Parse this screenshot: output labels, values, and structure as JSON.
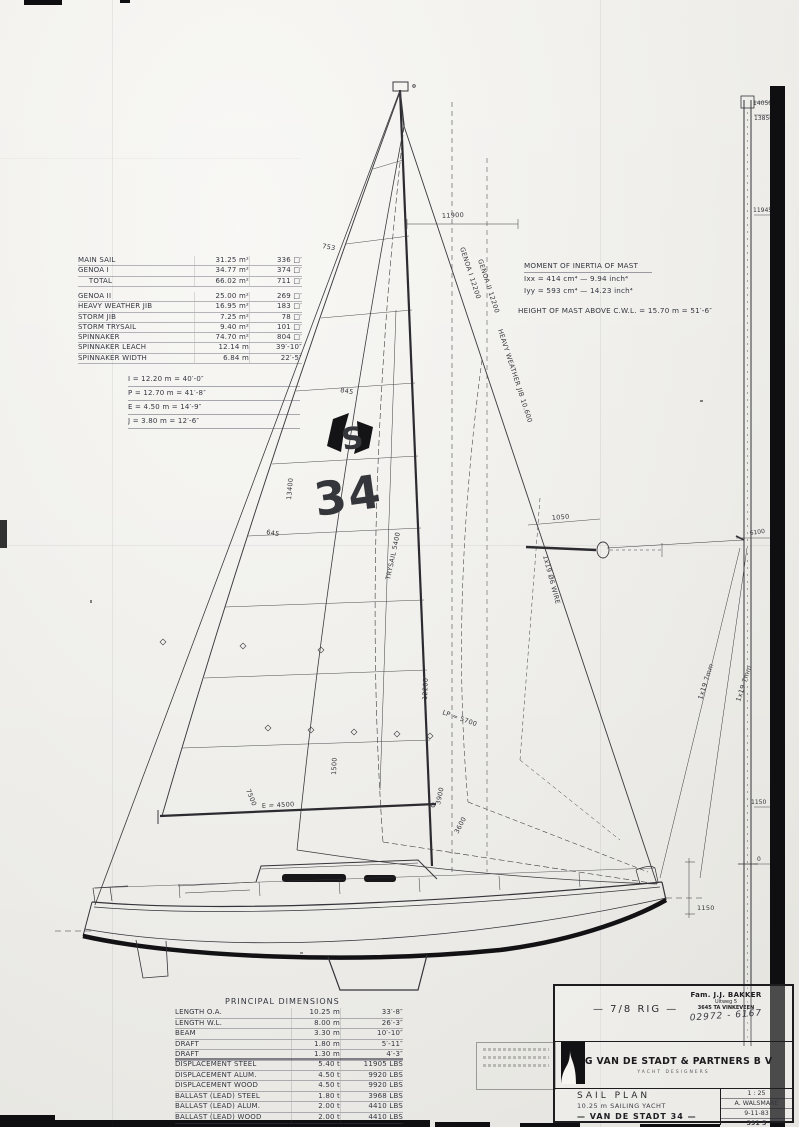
{
  "sheet": {
    "paper": "#f6f5f0",
    "ink": "#3a3a3e",
    "accent": "#111111"
  },
  "sail_table": {
    "group1": [
      {
        "label": "MAIN SAIL",
        "metric": "31.25 m²",
        "imperial": "336 □′"
      },
      {
        "label": "GENOA I",
        "metric": "34.77 m²",
        "imperial": "374 □′"
      },
      {
        "label": "  TOTAL",
        "metric": "66.02 m²",
        "imperial": "711 □′"
      }
    ],
    "group2": [
      {
        "label": "GENOA II",
        "metric": "25.00 m²",
        "imperial": "269 □′"
      },
      {
        "label": "HEAVY WEATHER JIB",
        "metric": "16.95 m²",
        "imperial": "183 □′"
      },
      {
        "label": "STORM JIB",
        "metric": "7.25 m²",
        "imperial": "78 □′"
      },
      {
        "label": "STORM TRYSAIL",
        "metric": "9.40 m²",
        "imperial": "101 □′"
      },
      {
        "label": "SPINNAKER",
        "metric": "74.70 m²",
        "imperial": "804 □′"
      },
      {
        "label": "SPINNAKER LEACH",
        "metric": "12.14 m",
        "imperial": "39′-10″"
      },
      {
        "label": "SPINNAKER WIDTH",
        "metric": "6.84 m",
        "imperial": "22′-5″"
      }
    ]
  },
  "rig_dims": [
    {
      "text": "I  =  12.20 m  =  40′-0″"
    },
    {
      "text": "P  =  12.70 m  =  41′-8″"
    },
    {
      "text": "E  =  4.50 m  =  14′-9″"
    },
    {
      "text": "J  =  3.80 m  =  12′-6″"
    }
  ],
  "inertia": {
    "title": "MOMENT OF INERTIA OF MAST",
    "rows": [
      {
        "text": "Ixx  =  414 cm⁴  —  9.94 inch⁴"
      },
      {
        "text": "Iyy  =  593 cm⁴  —  14.23 inch⁴"
      }
    ],
    "height_note": "HEIGHT OF MAST ABOVE C.W.L. = 15.70 m = 51′-6″"
  },
  "principal": {
    "title": "PRINCIPAL DIMENSIONS",
    "dims": [
      {
        "label": "LENGTH O.A.",
        "metric": "10.25 m",
        "imperial": "33′-8″"
      },
      {
        "label": "LENGTH W.L.",
        "metric": "8.00 m",
        "imperial": "26′-3″"
      },
      {
        "label": "BEAM",
        "metric": "3.30 m",
        "imperial": "10′-10″"
      },
      {
        "label": "DRAFT",
        "metric": "1.80 m",
        "imperial": "5′-11″"
      },
      {
        "label": "DRAFT",
        "metric": "1.30 m",
        "imperial": "4′-3″"
      }
    ],
    "weights": [
      {
        "label": "DISPLACEMENT STEEL",
        "metric": "5.40 t",
        "imperial": "11905 LBS"
      },
      {
        "label": "DISPLACEMENT ALUM.",
        "metric": "4.50 t",
        "imperial": "9920 LBS"
      },
      {
        "label": "DISPLACEMENT WOOD",
        "metric": "4.50 t",
        "imperial": "9920 LBS"
      },
      {
        "label": "BALLAST (LEAD) STEEL",
        "metric": "1.80 t",
        "imperial": "3968 LBS"
      },
      {
        "label": "BALLAST (LEAD) ALUM.",
        "metric": "2.00 t",
        "imperial": "4410 LBS"
      },
      {
        "label": "BALLAST (LEAD) WOOD",
        "metric": "2.00 t",
        "imperial": "4410 LBS"
      }
    ]
  },
  "insignia": {
    "s": "S",
    "number": "34"
  },
  "annotations": [
    {
      "text": "11900"
    },
    {
      "text": "GENOA I  12200"
    },
    {
      "text": "GENOA II  12200"
    },
    {
      "text": "HEAVY WEATHER JIB  10.600"
    },
    {
      "text": "TRYSAIL 5400"
    },
    {
      "text": "12200"
    },
    {
      "text": "13400"
    },
    {
      "text": "753"
    },
    {
      "text": "845"
    },
    {
      "text": "645"
    },
    {
      "text": "1050"
    },
    {
      "text": "E = 4500"
    },
    {
      "text": "7500"
    },
    {
      "text": "1500"
    },
    {
      "text": "LP = 5700"
    },
    {
      "text": "3900"
    },
    {
      "text": "3600"
    },
    {
      "text": "1150"
    },
    {
      "text": "1x19  7mm"
    },
    {
      "text": "1x19  7mm"
    },
    {
      "text": "1x19 Ø6 WIRE"
    }
  ],
  "profile_labels": [
    "14050",
    "13850",
    "11945",
    "6100",
    "1150",
    "0"
  ],
  "title_block": {
    "rig_label": "—  7/8 RIG  —",
    "stamp": {
      "line1": "Fam. J.J. BAKKER",
      "line2": "Uitweg 5",
      "line3": "3645 TA  VINKEVEEN",
      "phone": "02972 - 6167"
    },
    "company": "E G  VAN DE STADT & PARTNERS  B V",
    "subtitle": "YACHT DESIGNERS",
    "doc_title": "SAIL PLAN",
    "doc_subtitle": "10.25 m  SAILING YACHT",
    "doc_name": "—  VAN DE STADT 34  —",
    "scale": "1 : 25",
    "draughtsman": "A. WALSMARE",
    "date": "9-11-83",
    "number": "391   5"
  }
}
